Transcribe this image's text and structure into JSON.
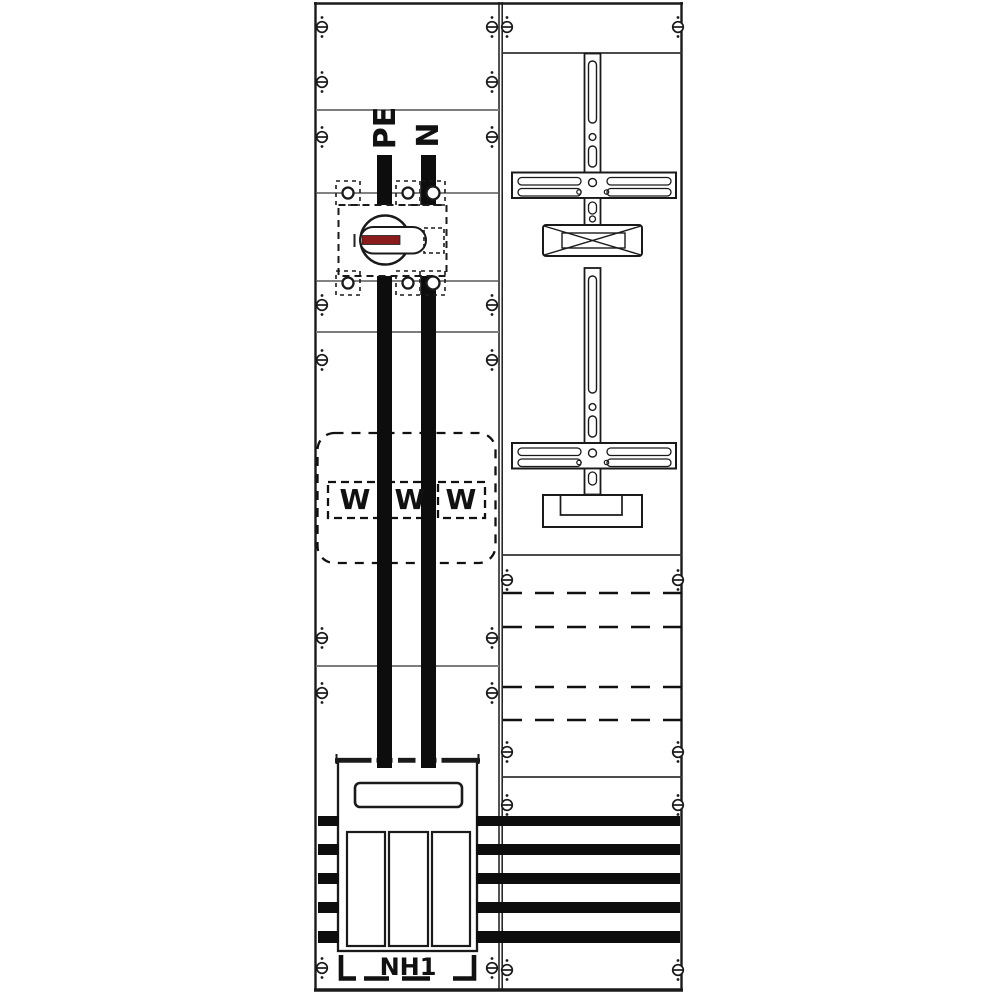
{
  "diagram": {
    "left_panel": {
      "pe_label": "PE",
      "n_label": "N",
      "meter_labels": [
        "W",
        "W",
        "W"
      ],
      "fuse_label": "NH1"
    },
    "colors": {
      "background": "#ffffff",
      "line_black": "#1a1a1a",
      "section_line_gray": "#7d7d7d",
      "busbar_black": "#0d0d0d",
      "switch_handle_red": "#8b1c1c"
    },
    "icons": [
      {
        "name": "screw-icon",
        "glyph": "circle-with-slot"
      },
      {
        "name": "rotary-switch-icon",
        "glyph": "circle-with-pill-handle"
      },
      {
        "name": "terminal-clamp-icon",
        "glyph": "small-circle-in-dashed-bracket"
      },
      {
        "name": "mounting-rail-icon",
        "glyph": "slotted-vertical-rail"
      },
      {
        "name": "rail-crossbar-icon",
        "glyph": "slotted-horizontal-bar"
      },
      {
        "name": "busbar-support-icon",
        "glyph": "crossed-rectangle"
      }
    ]
  }
}
